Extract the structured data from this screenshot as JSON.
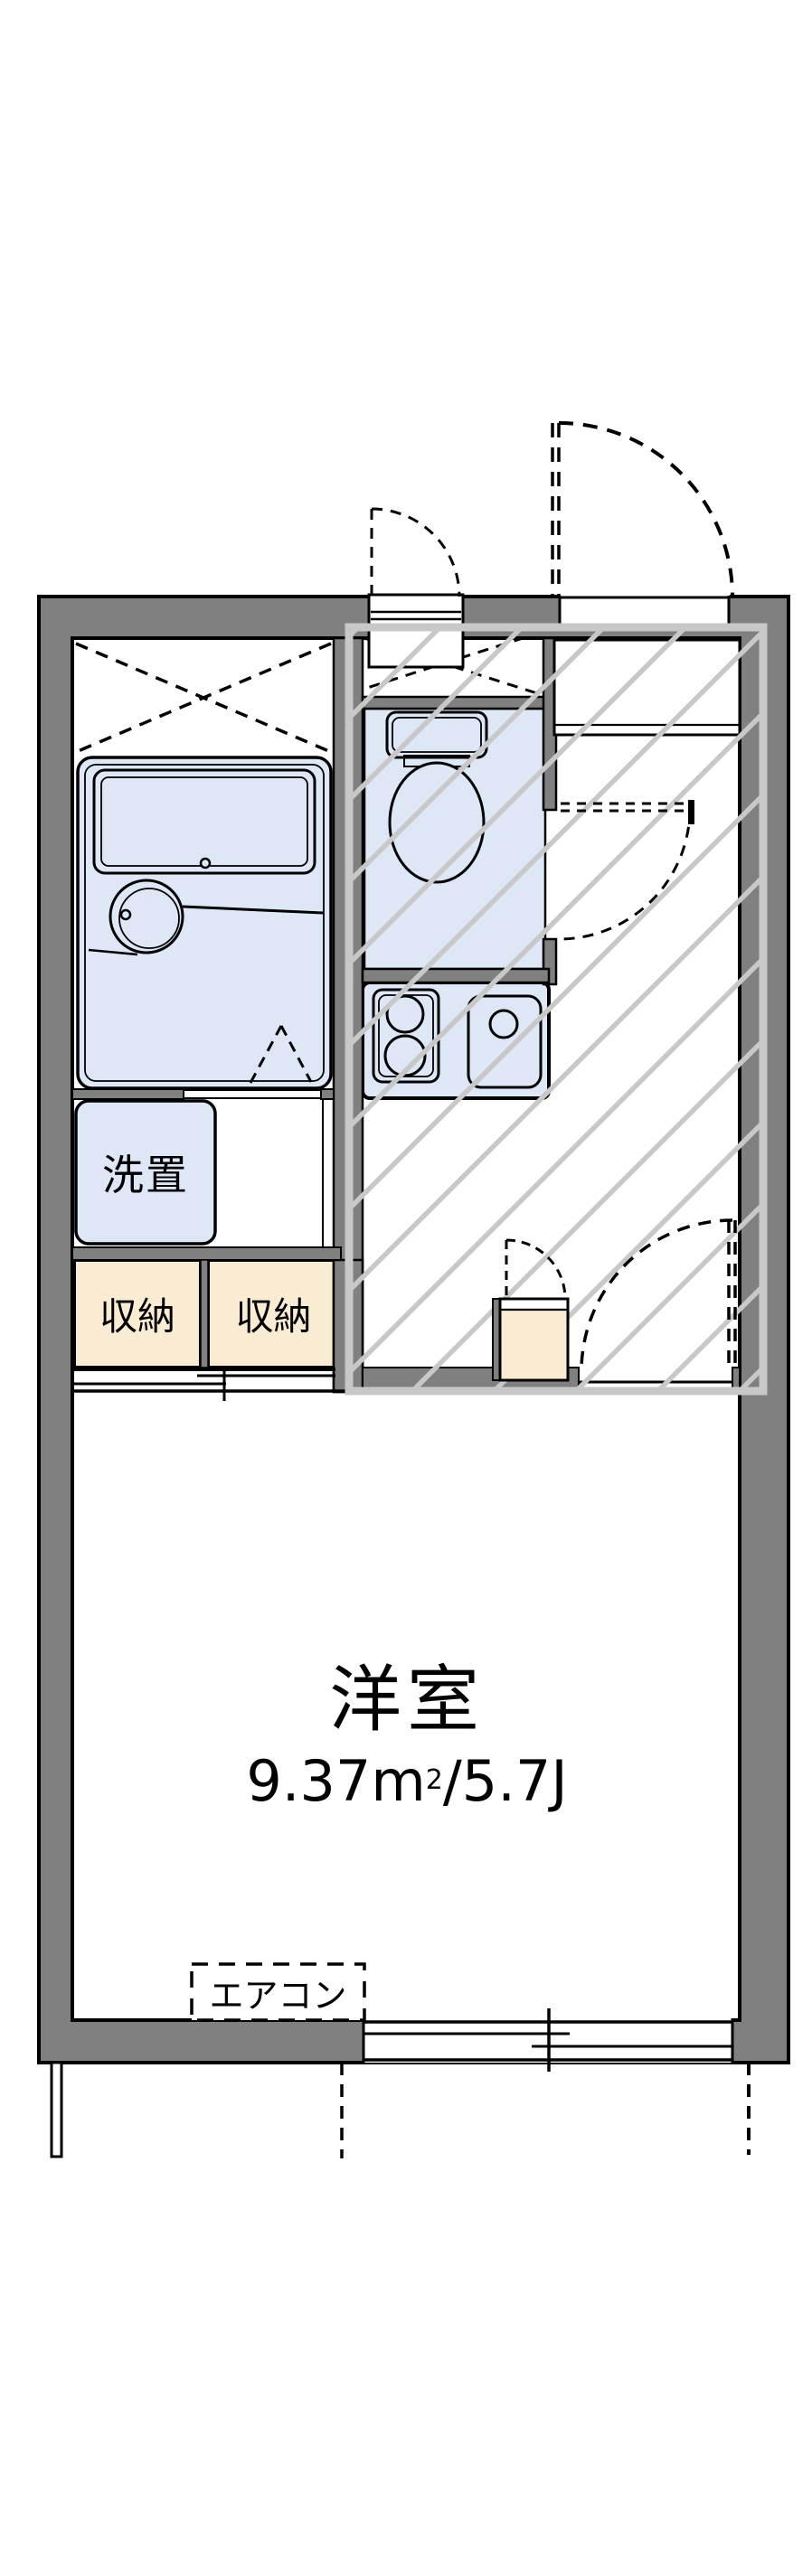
{
  "plan": {
    "type": "apartment-floor-plan",
    "labels": {
      "laundry": "洗置",
      "storage_left": "収納",
      "storage_right": "収納",
      "main_room_name": "洋室",
      "main_room_area_base": "9.37m",
      "main_room_area_sup": "2",
      "main_room_area_tail": "/5.7J",
      "aircon": "エアコン"
    },
    "colors": {
      "background": "#ffffff",
      "wall_fill": "#808080",
      "outline": "#000000",
      "wet_area_fill": "#dde7f6",
      "storage_fill": "#faecd2",
      "entry_hatch": "#c8c8c8"
    }
  }
}
